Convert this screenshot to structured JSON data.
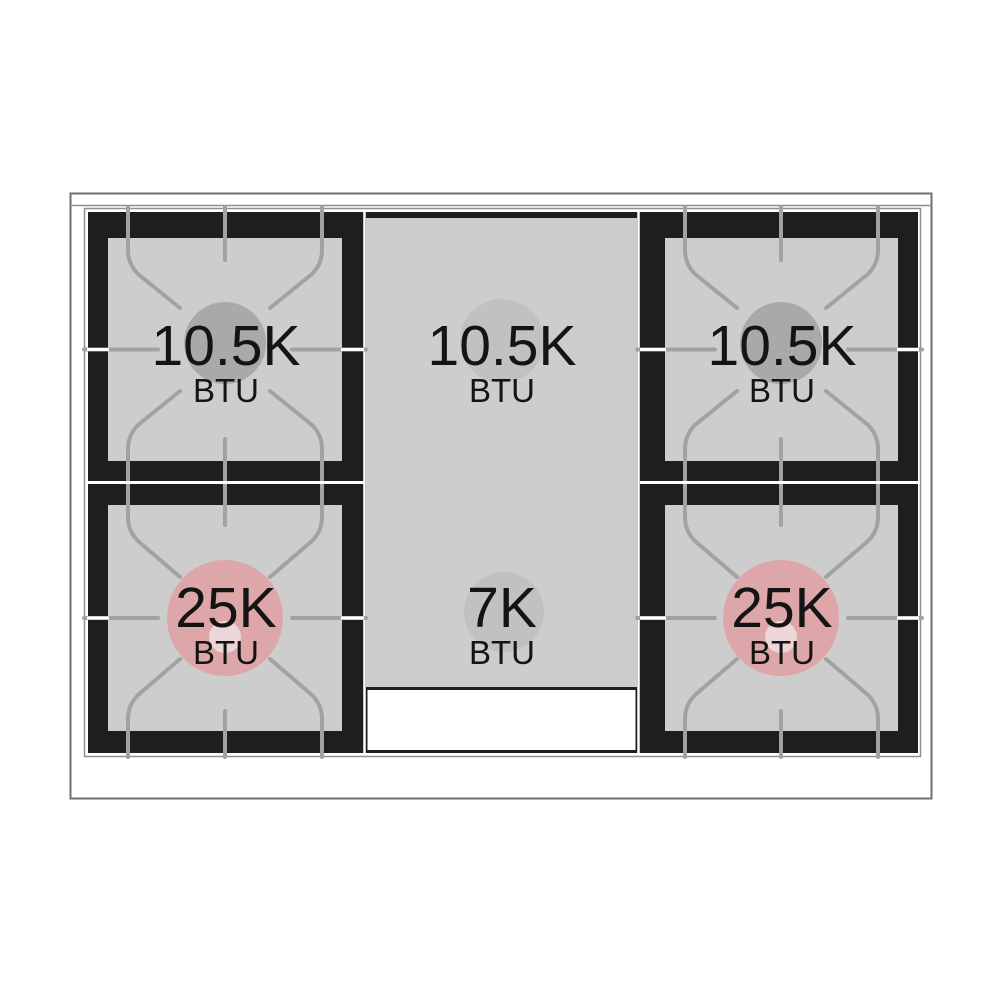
{
  "diagram": {
    "burners": [
      {
        "position": "left-rear",
        "rating": "10.5K",
        "unit": "BTU"
      },
      {
        "position": "center-rear-griddle",
        "rating": "10.5K",
        "unit": "BTU"
      },
      {
        "position": "right-rear",
        "rating": "10.5K",
        "unit": "BTU"
      },
      {
        "position": "left-front",
        "rating": "25K",
        "unit": "BTU"
      },
      {
        "position": "center-front-griddle",
        "rating": "7K",
        "unit": "BTU"
      },
      {
        "position": "right-front",
        "rating": "25K",
        "unit": "BTU"
      }
    ]
  },
  "colors": {
    "cooktop_black": "#1e1e1e",
    "surface_gray": "#cdcdcd",
    "grate_gray": "#a2a2a2",
    "rear_burner_gray": "#a9a9a9",
    "griddle_burner_gray": "#c1c1c1",
    "high_output_pink": "#dda7aa",
    "high_output_pink_inner": "#edd6d7",
    "text_black": "#141414",
    "frame_gray": "#6f6f6f",
    "frame_light": "#8f8f8f"
  }
}
